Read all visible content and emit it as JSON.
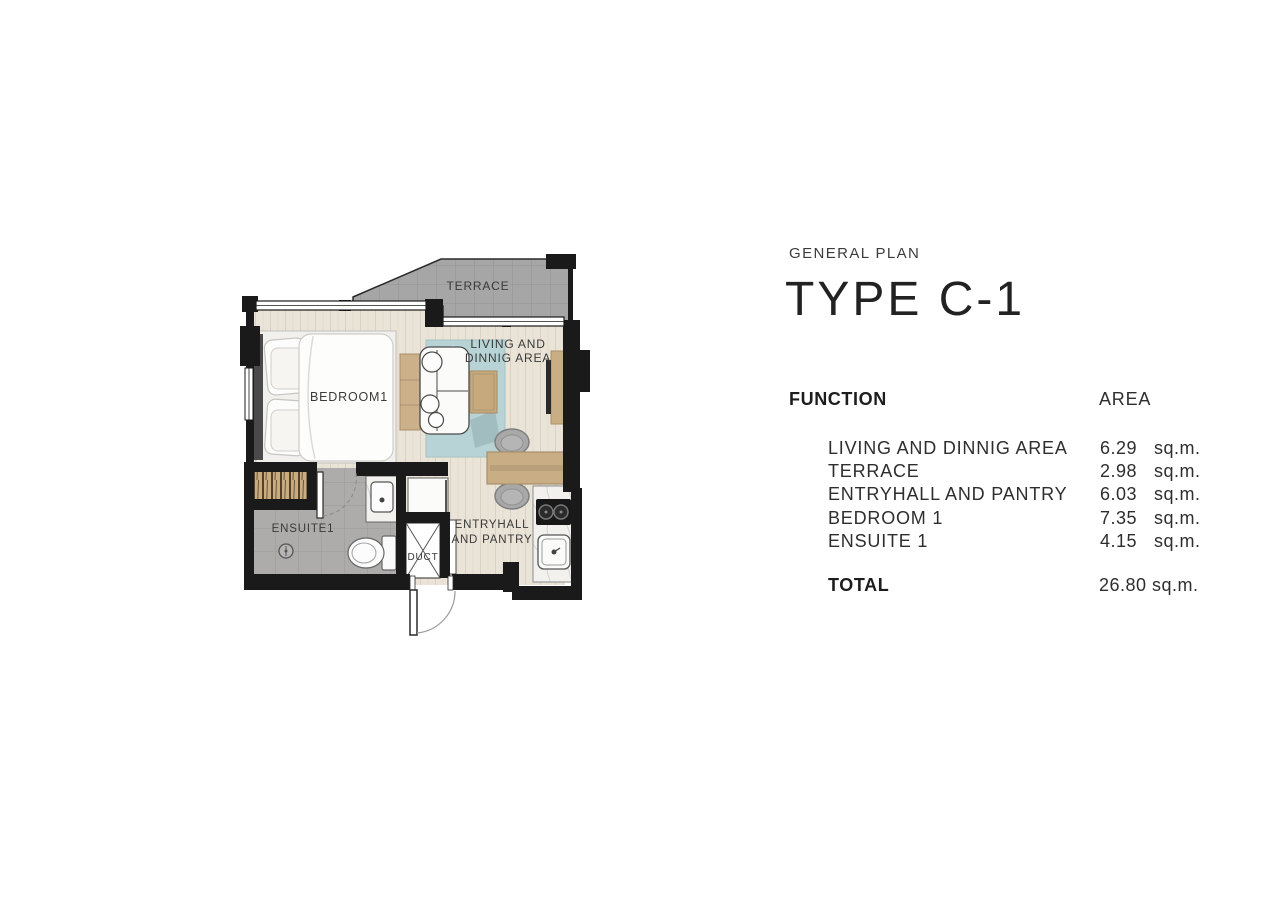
{
  "panel": {
    "eyebrow": "GENERAL PLAN",
    "title": "TYPE C-1",
    "table": {
      "function_header": "FUNCTION",
      "area_header": "AREA",
      "rows": [
        {
          "name": "LIVING AND DINNIG AREA",
          "value": "6.29",
          "unit": "sq.m."
        },
        {
          "name": "TERRACE",
          "value": "2.98",
          "unit": "sq.m."
        },
        {
          "name": "ENTRYHALL AND PANTRY",
          "value": "6.03",
          "unit": "sq.m."
        },
        {
          "name": "BEDROOM 1",
          "value": "7.35",
          "unit": "sq.m."
        },
        {
          "name": "ENSUITE 1",
          "value": "4.15",
          "unit": "sq.m."
        }
      ],
      "total_label": "TOTAL",
      "total_value": "26.80 sq.m."
    }
  },
  "plan": {
    "labels": {
      "terrace": "TERRACE",
      "living": [
        "LIVING AND",
        "DINNIG AREA"
      ],
      "bedroom": "BEDROOM1",
      "ensuite": "ENSUITE1",
      "entry": [
        "ENTRYHALL",
        "AND PANTRY"
      ],
      "duct": "DUCT"
    }
  },
  "colors": {
    "wall": "#1a1a1a",
    "wood_floor": "#eae3d7",
    "ensuite_tile": "#adacaa",
    "terrace_tile": "#a6a6a6",
    "rug": "#b8d3d5",
    "furniture_wood": "#c9ae85",
    "text": "#2e2e2e"
  }
}
